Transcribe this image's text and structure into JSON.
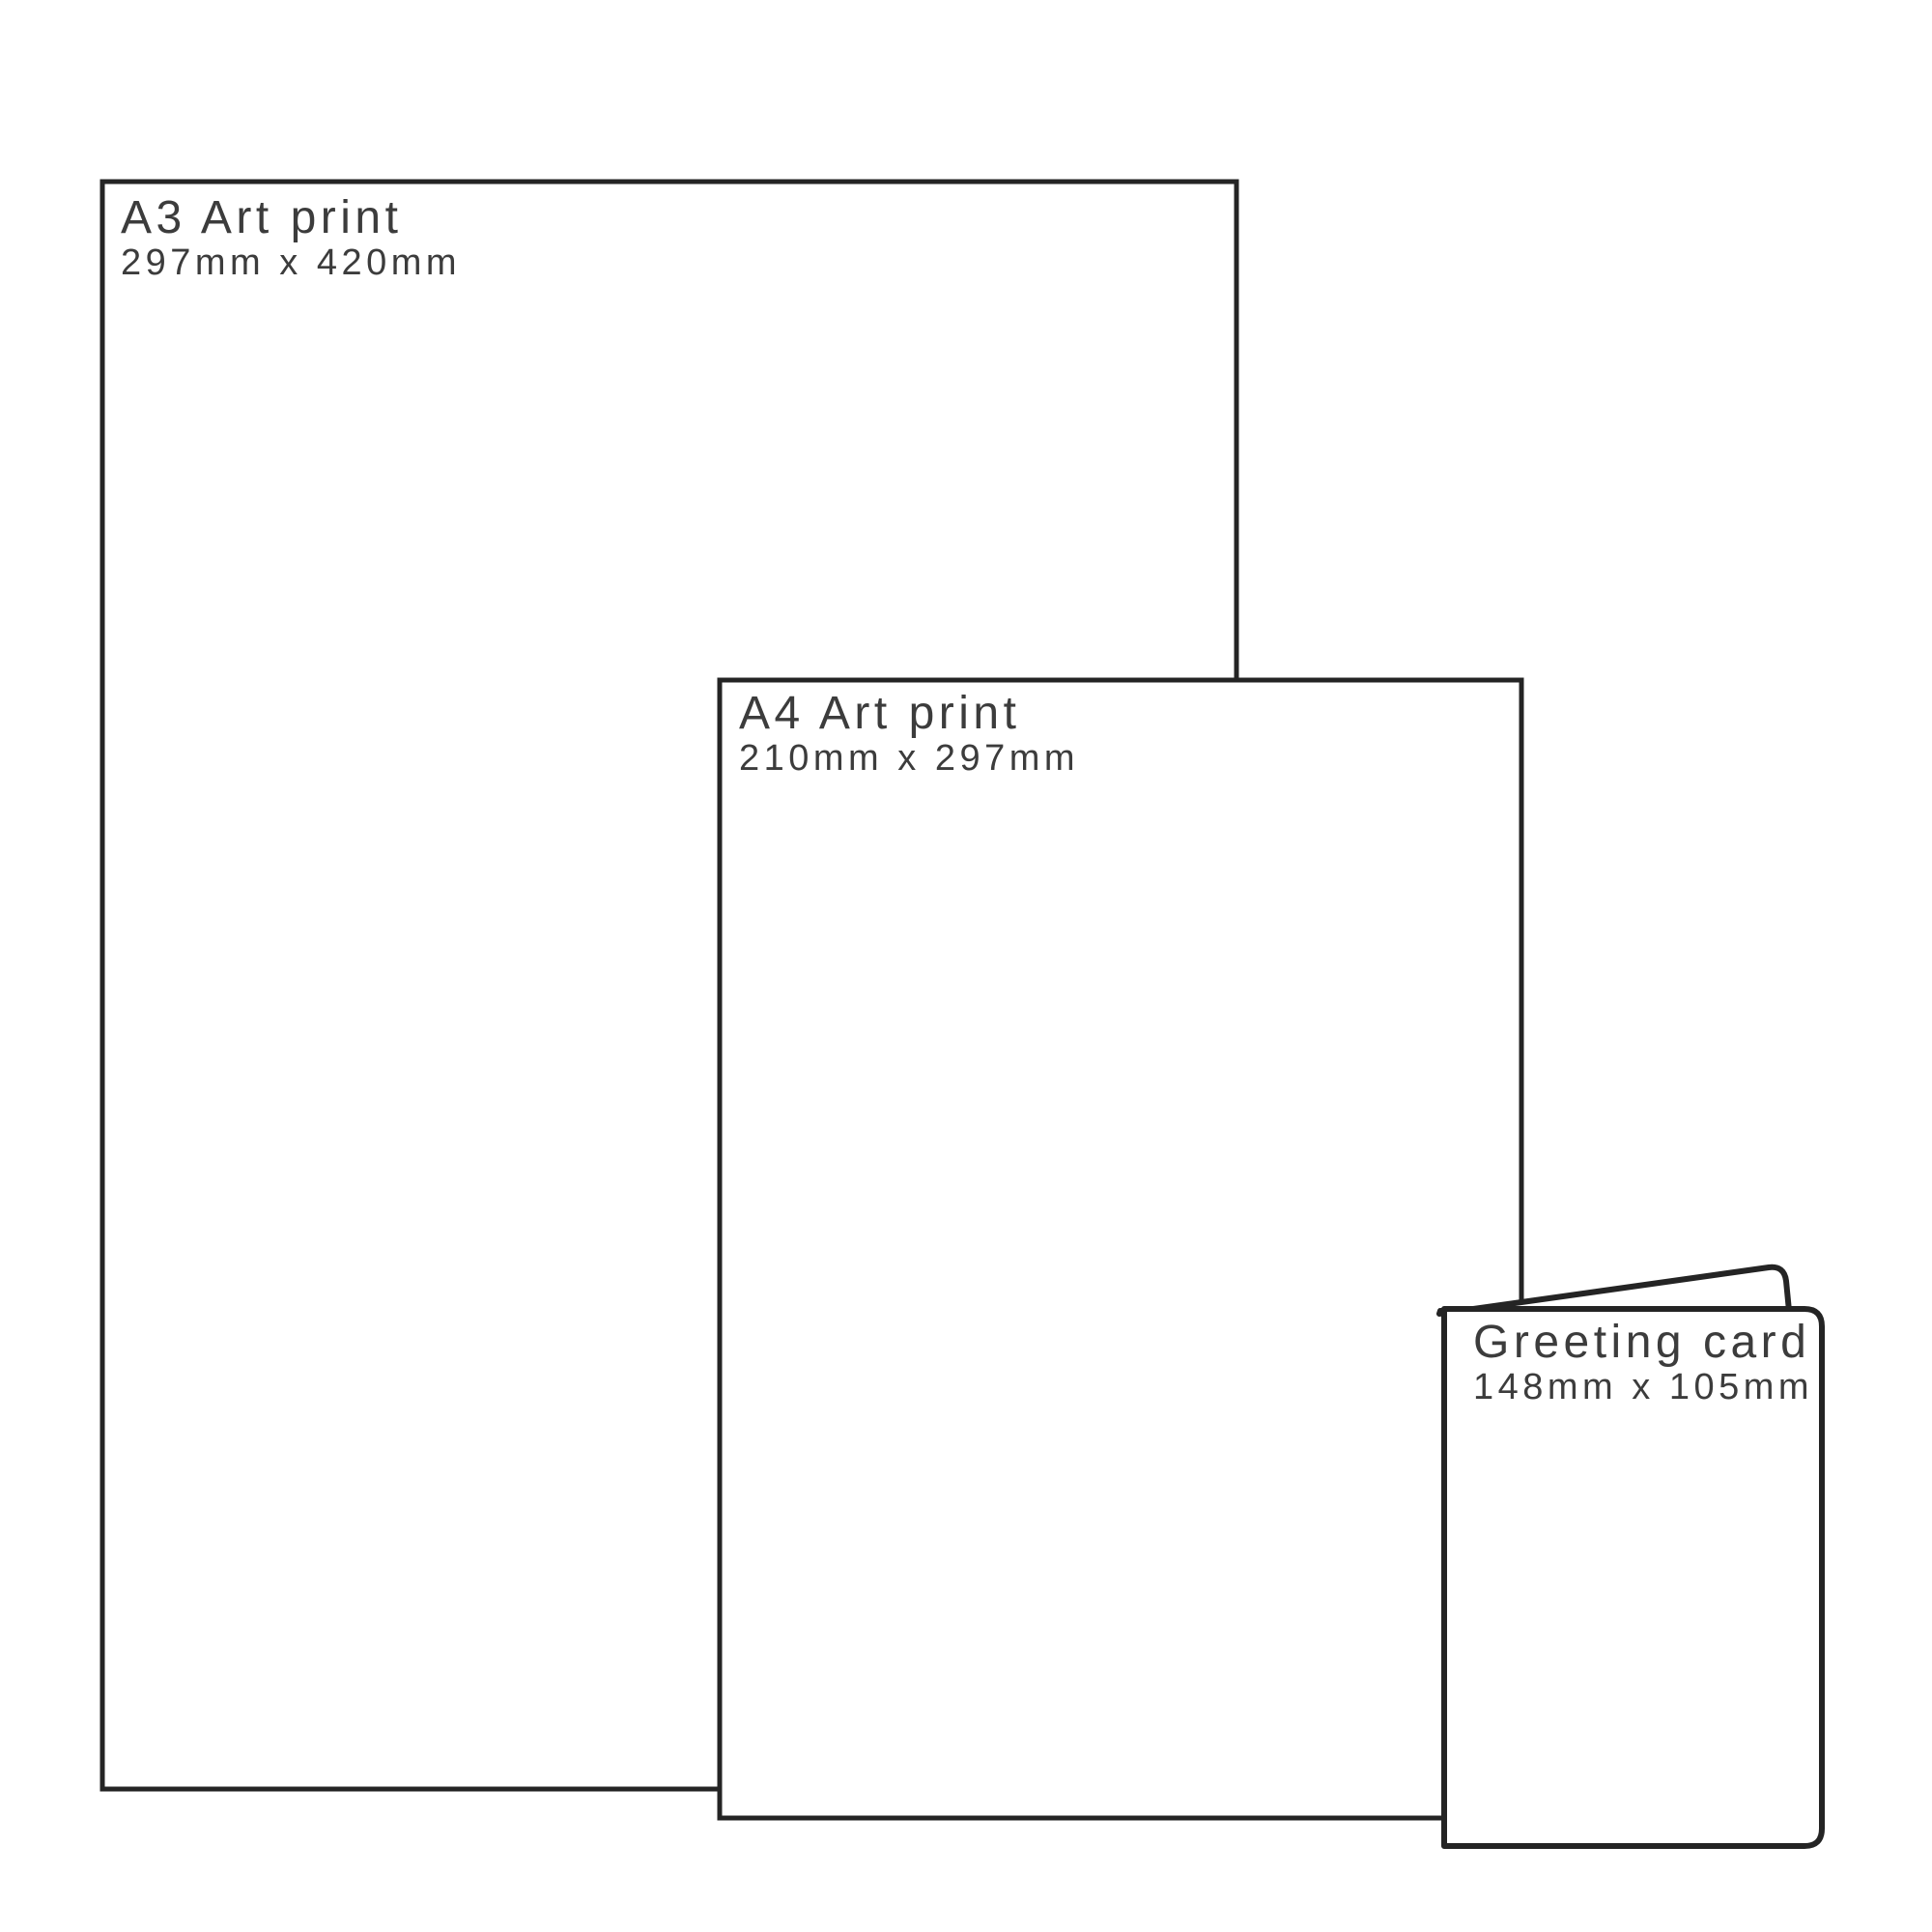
{
  "image": {
    "kind": "print-size-comparison-diagram",
    "background": "#ffffff",
    "line_color": "#242424",
    "text_color": "#3c3c3c"
  },
  "items": [
    {
      "name": "a3-art-print",
      "title": "A3 Art print",
      "dims": "297mm x 420mm"
    },
    {
      "name": "a4-art-print",
      "title": "A4 Art print",
      "dims": "210mm x 297mm"
    },
    {
      "name": "greeting-card",
      "title": "Greeting card",
      "dims": "148mm x 105mm"
    }
  ]
}
